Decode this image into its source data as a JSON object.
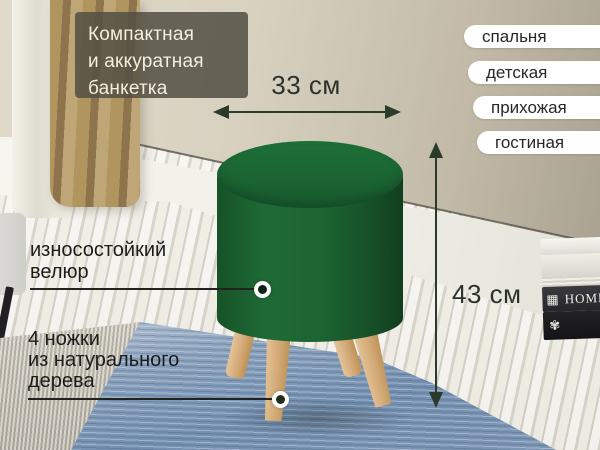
{
  "title_lines": [
    "Компактная",
    "и аккуратная",
    "банкетка"
  ],
  "rooms": [
    "спальня",
    "детская",
    "прихожая",
    "гостиная"
  ],
  "dimensions": {
    "width": "33 см",
    "height": "43 см"
  },
  "features": {
    "velour_lines": [
      "износостойкий",
      "велюр"
    ],
    "legs_lines": [
      "4 ножки",
      "из натурального",
      "дерева"
    ]
  },
  "books": {
    "home_title": "HOME",
    "home_ornament": "▦",
    "floral_ornament": "✾"
  },
  "colors": {
    "ottoman_green": "#1d6433",
    "wood_leg": "#d3a976",
    "arrow_dark": "#2a3a2b",
    "pill_bg": "#ffffff",
    "pill_text": "#272727",
    "title_box_bg": "rgba(85,80,69,0.87)",
    "title_text": "#f4eedd",
    "rug_blue": "#7d97b6",
    "wall_beige": "#d8d1c0"
  }
}
